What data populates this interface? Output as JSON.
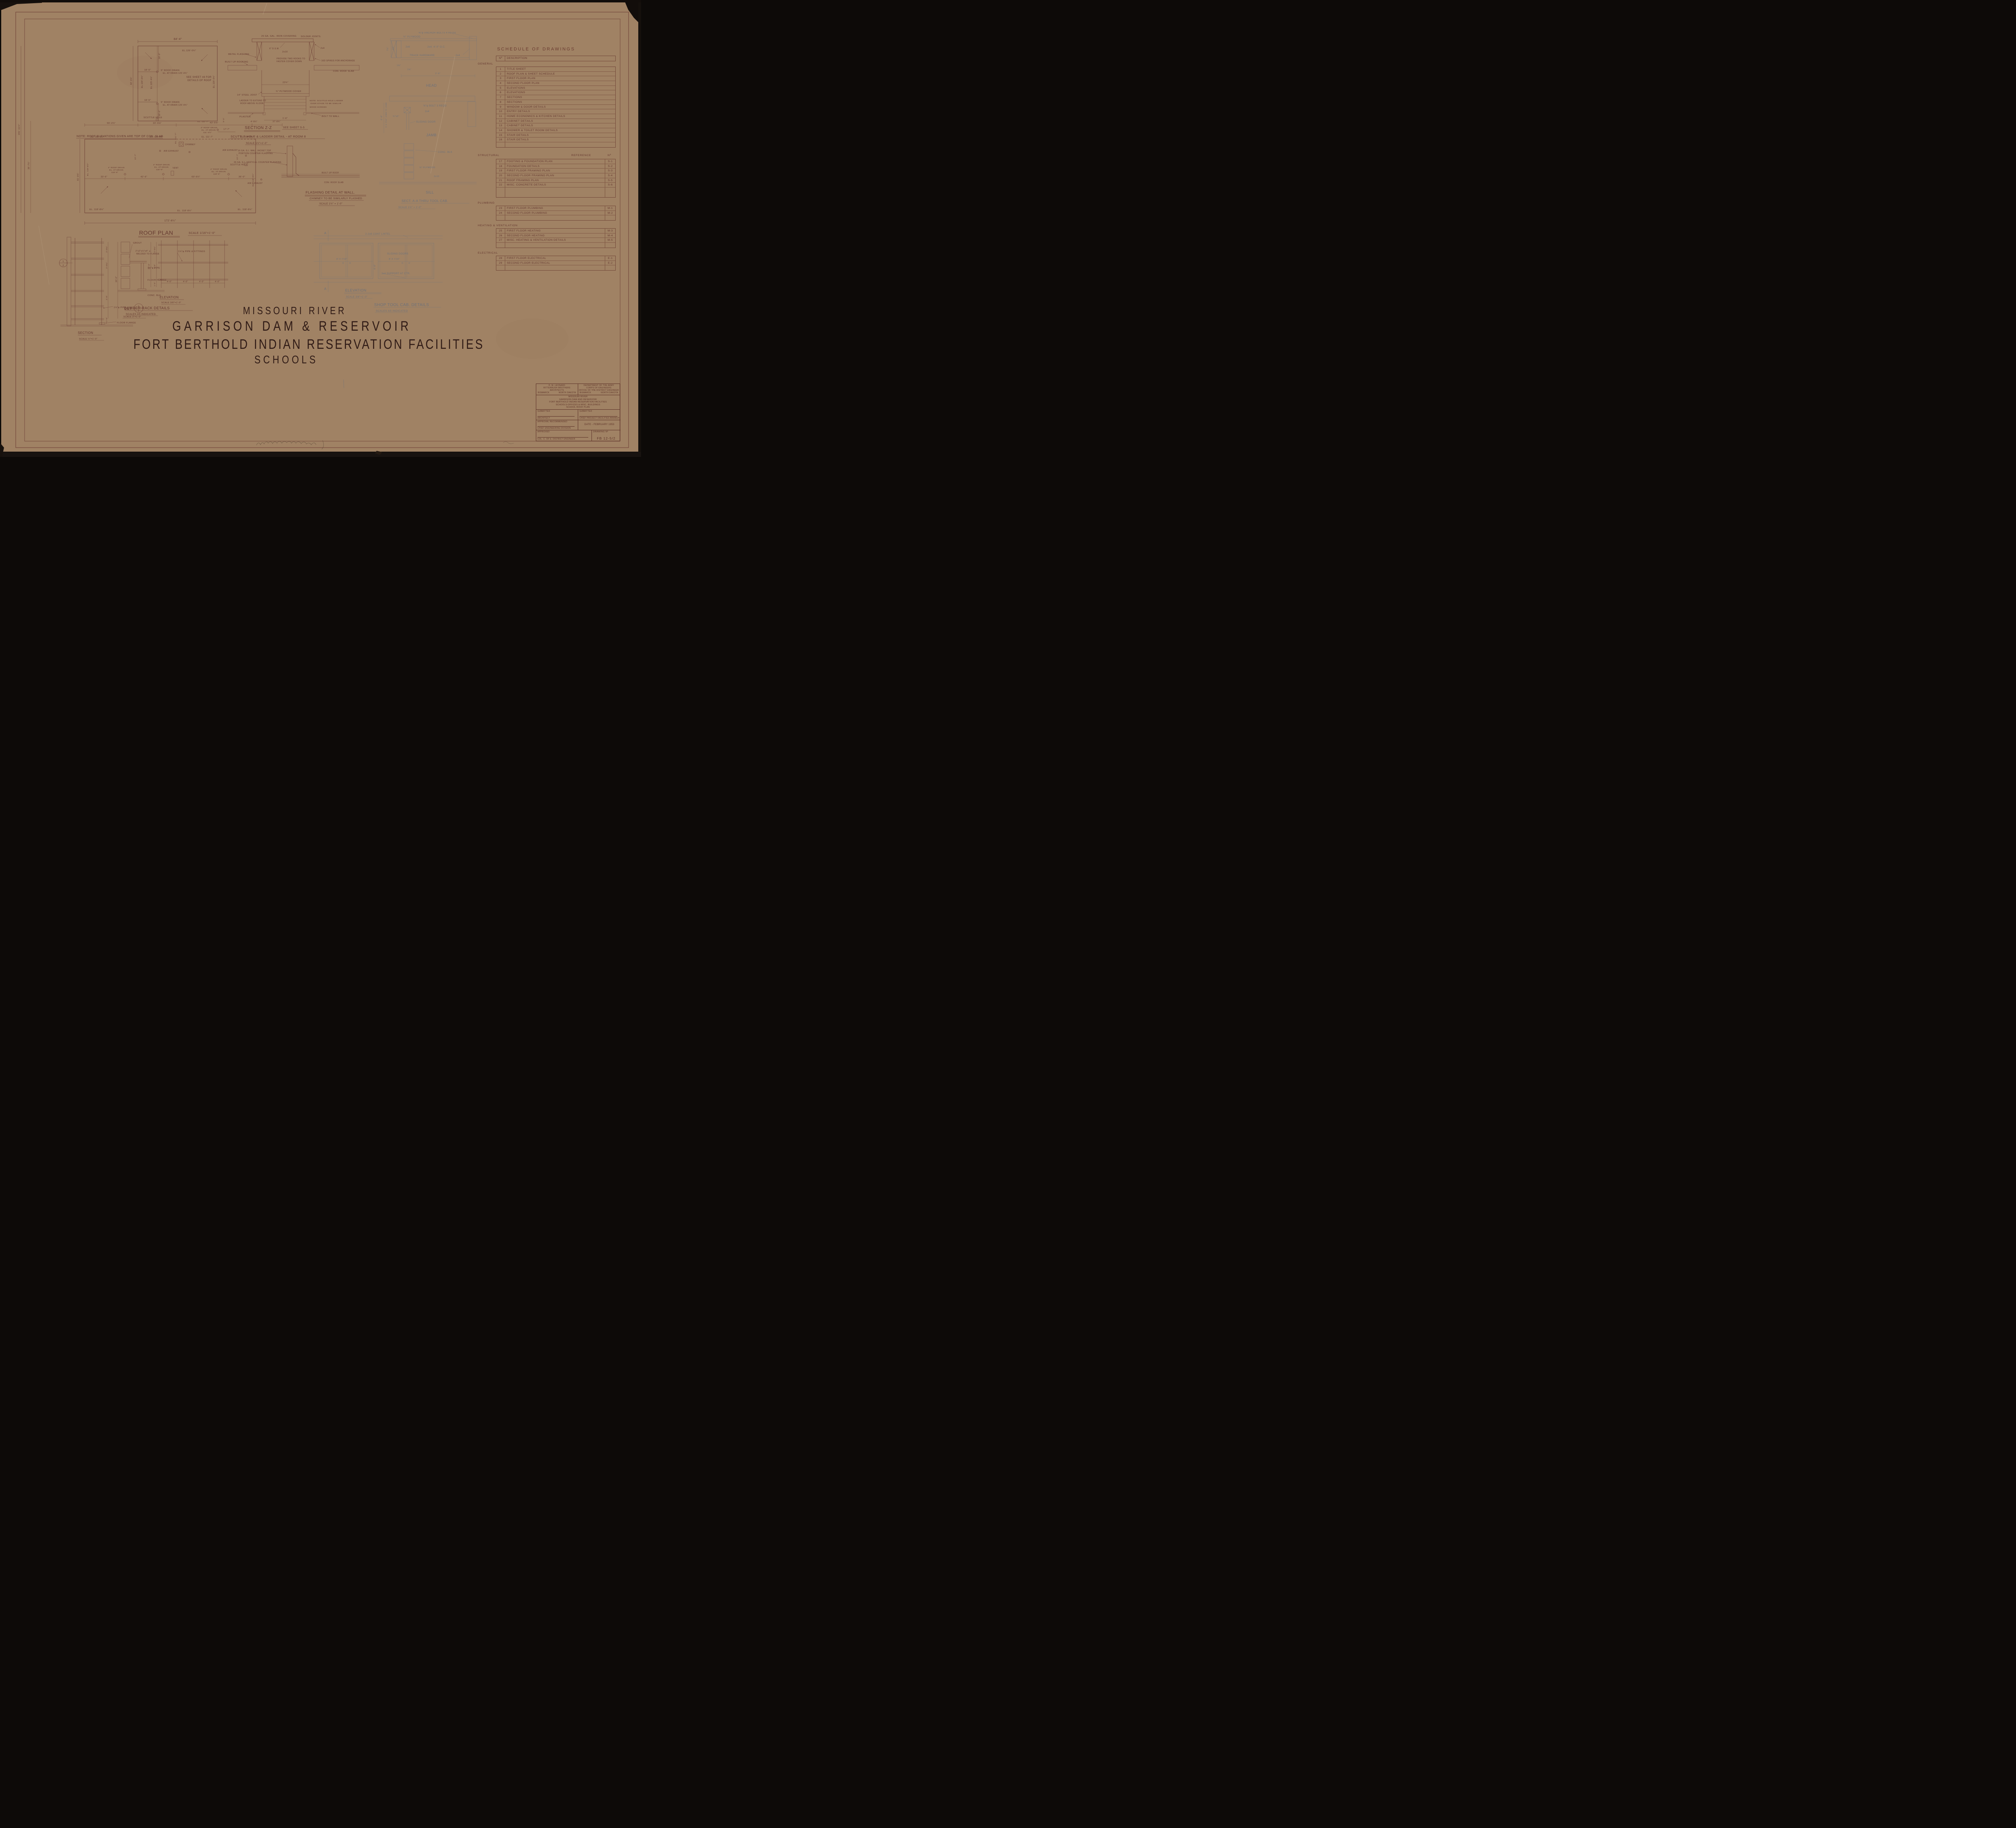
{
  "sheet_title": {
    "l1": "MISSOURI  RIVER",
    "l2": "GARRISON  DAM  &  RESERVOIR",
    "l3": "FORT BERTHOLD  INDIAN  RESERVATION  FACILITIES",
    "l4": "SCHOOLS"
  },
  "schedule": {
    "title": "SCHEDULE  OF  DRAWINGS",
    "col_no": "Nº",
    "col_desc": "DESCRIPTION",
    "ref_label": "REFERENCE",
    "ref_no": "Nº",
    "sections": [
      {
        "name": "GENERAL",
        "rows": [
          {
            "no": "1",
            "desc": "TITLE SHEET",
            "ref": ""
          },
          {
            "no": "2",
            "desc": "ROOF PLAN & SHEET SCHEDULE",
            "ref": ""
          },
          {
            "no": "3",
            "desc": "FIRST FLOOR PLAN",
            "ref": ""
          },
          {
            "no": "4",
            "desc": "SECOND FLOOR PLAN",
            "ref": ""
          },
          {
            "no": "5",
            "desc": "ELEVATIONS",
            "ref": ""
          },
          {
            "no": "6",
            "desc": "ELEVATIONS",
            "ref": ""
          },
          {
            "no": "7",
            "desc": "SECTIONS",
            "ref": ""
          },
          {
            "no": "8",
            "desc": "SECTIONS",
            "ref": ""
          },
          {
            "no": "9",
            "desc": "WINDOW & DOOR DETAILS",
            "ref": ""
          },
          {
            "no": "10",
            "desc": "ENTRY DETAILS",
            "ref": ""
          },
          {
            "no": "11",
            "desc": "HOME ECONOMICS & KITCHEN DETAILS",
            "ref": ""
          },
          {
            "no": "12",
            "desc": "CABINET DETAILS",
            "ref": ""
          },
          {
            "no": "13",
            "desc": "CABINET DETAILS",
            "ref": ""
          },
          {
            "no": "14",
            "desc": "SHOWER & TOILET ROOM DETAILS",
            "ref": ""
          },
          {
            "no": "15",
            "desc": "STAIR DETAILS",
            "ref": ""
          },
          {
            "no": "16",
            "desc": "STAIR DETAILS",
            "ref": ""
          }
        ]
      },
      {
        "name": "STRUCTURAL",
        "rows": [
          {
            "no": "17",
            "desc": "FOOTING & FOUNDATION PLAN",
            "ref": "S-1"
          },
          {
            "no": "18",
            "desc": "FOUNDATION DETAILS",
            "ref": "S-2"
          },
          {
            "no": "19",
            "desc": "FIRST FLOOR FRAMING PLAN",
            "ref": "S-3"
          },
          {
            "no": "20",
            "desc": "SECOND FLOOR FRAMING PLAN",
            "ref": "S-4"
          },
          {
            "no": "21",
            "desc": "ROOF FRAMING PLAN",
            "ref": "S-5"
          },
          {
            "no": "22",
            "desc": "MISC. CONCRETE DETAILS",
            "ref": "S-6"
          }
        ]
      },
      {
        "name": "PLUMBING",
        "rows": [
          {
            "no": "23",
            "desc": "FIRST FLOOR PLUMBING",
            "ref": "M-1"
          },
          {
            "no": "24",
            "desc": "SECOND FLOOR PLUMBING",
            "ref": "M-2"
          }
        ]
      },
      {
        "name": "HEATING & VENTILATION",
        "rows": [
          {
            "no": "25",
            "desc": "FIRST FLOOR HEATING",
            "ref": "M-3"
          },
          {
            "no": "26",
            "desc": "SECOND FLOOR HEATING",
            "ref": "M-4"
          },
          {
            "no": "27",
            "desc": "MISC. HEATING & VENTILATION DETAILS",
            "ref": "M-5"
          }
        ]
      },
      {
        "name": "ELECTRICAL",
        "rows": [
          {
            "no": "28",
            "desc": "FIRST FLOOR ELECTRICAL",
            "ref": "E-1"
          },
          {
            "no": "29",
            "desc": "SECOND FLOOR ELECTRICAL",
            "ref": "E-2"
          }
        ]
      }
    ]
  },
  "titleblock": {
    "firm_l1": "H. M. LEONARD",
    "firm_l2": "RITTERBUSH BROTHERS",
    "firm_l3": "ARCHITECTS",
    "firm_city": "BISMARCK",
    "firm_state": "NORTH DAKOTA",
    "army_l1": "DEPARTMENT OF THE ARMY",
    "army_l2": "CORPS OF ENGINEERS",
    "army_l3": "OFFICE OF THE DISTRICT ENGINEER",
    "army_city": "BISMARCK",
    "army_state": "NORTH DAKOTA",
    "proj_l1": "MISSOURI RIVER",
    "proj_l2": "GARRISON DAM AND RESERVOIR",
    "proj_l3": "FORT BERTHOLD INDIAN RESERVATION FACILITIES",
    "proj_l4": "SCHOOLS-OFFICES & MISC. BUILDINGS",
    "proj_l5": "SCHOOL ROOF PLAN",
    "submitted": "SUBMITTED",
    "architect": "ARCHITECT",
    "approval": "APPROVAL RECOMMENDED",
    "chief_eng": "CHIEF ENGINEERING DIVISION",
    "approved": "APPROVED",
    "district_eng": "COL. C. OF E. DISTRICT ENGINEER",
    "chief_proj": "CHIEF PROJECT FACILITIES BRANCH",
    "date": "DATE - FEBRUARY 1953",
    "drawing_no_label": "DRAWING Nº",
    "drawing_no": "FB 12-5/2"
  },
  "roof": {
    "title": "ROOF PLAN",
    "scale": "SCALE 1/16\"=1'-0\"",
    "note": "NOTE:  ROOF ELEVATIONS GIVEN ARE TOP OF CON. SLAB",
    "dim_top": "84'-4\"",
    "el_126": "EL.126'-0¾\"",
    "el_125": "EL.125'-4¾\"",
    "dim_18_0": "18'-0\"",
    "dim_18_5": "18'-5\"",
    "drain5_l1": "5\" ROOF DRAIN",
    "drain5_l2": "EL. AT DRAIN 125'-4¾\"",
    "see_l1": "SEE SHEET #8 FOR",
    "see_l2": "DETAILS OF ROOF",
    "scuttle": "SCUTTLE HOLE",
    "dim_82": "82'-3¾\"",
    "dim_181": "181'-11¾\"",
    "dim_38": "38'-7¼\"",
    "dim_61": "61'-0¾\"",
    "dim_56": "56'-2¼\"",
    "dim_30": "30'-9⅛\"",
    "dim_43": "43'-0⅞\"",
    "dim_8_3": "8'-3\"",
    "dim_4_9": "4'-9¼\"",
    "dim_37": "37'-8¾\"",
    "dim_17_7": "17'-7\"",
    "drain3_l1": "3\" ROOF DRAIN",
    "drain3_l2": "EL. AT DRAIN",
    "drain3_l3": "111'-4½\"",
    "el_111": "EL. 111'-7\"",
    "el_118": "EL. 118'-8½\"",
    "chimney": "CHIMNEY",
    "air_exhaust": "AIR EXHAUST",
    "vent": "VENT",
    "drain4_l1": "4\" ROOF DRAIN",
    "drain4_l2": "EL. AT DRAIN",
    "drain4_l3": "118'-6\"",
    "dim_33": "33'-6\"",
    "dim_42": "42'-6\"",
    "dim_60": "60'-6¼\"",
    "dim_36": "36'-0\"",
    "dim_22_7": "22'-7\"",
    "dim_172": "172'-6¼\""
  },
  "zz": {
    "title": "SECTION Z-Z",
    "see": "SEE SHEET S-5",
    "sub": "SCUTTLE HOLE & LADDER DETAIL - AT ROOM 8",
    "scale": "SCALE 1½\"=1'-0\"",
    "covering": "26 GA. GAL. IRON COVERING",
    "solder": "SOLDER JOINTS.",
    "dsm": "6\" D.S.M.",
    "l2x4": "2x4",
    "metal_flashing": "METAL FLASHING",
    "built_up": "BUILT UP ROOFING",
    "l2x10": "2x10",
    "hooks_l1": "PROVIDE TWO HOOKS TO",
    "hooks_l2": "FASTEN COVER DOWN",
    "spikes": "16D SPIKES FOR ANCHORAGE",
    "slab": "CON. ROOF SLAB",
    "dim_22": "22¾\"",
    "joist": "14\" STEEL JOIST",
    "plywood": "¾\" PLYWOOD COVER",
    "plaster": "PLASTER",
    "bolt": "BOLT TO WALL",
    "dim_16": "1'-6\"",
    "ladder_l1": "LADDER TO EXTEND TO",
    "ladder_l2": "ROOF ABOVE FLOOR.",
    "note_l1": "NOTE: SCUTTLE HOLE LADDER",
    "note_l2": "OVER STAGE TO BE SIMILAR",
    "wood_screws": "WOOD SCREWS"
  },
  "flash": {
    "title": "FLASHING DETAIL AT WALL.",
    "sub": "CHIMNEY TO BE SIMILARLY FLASHED",
    "scale": "SCALE 1½\" = 1'-0\"",
    "jacket_l1": "16 GA. G.I. WALL JACKET TOP",
    "jacket_l2": "PORTION COUNTER FLASHING",
    "vert": "26 GA. G.I. VERTICAL COUNTER FLASHING",
    "built_up": "BUILT UP ROOF",
    "slab": "CON. ROOF SLAB"
  },
  "cab": {
    "anchor": "⅜\"φ ANCHOR BOLTS 4 REQD",
    "plywood34": "¾\" PLYWOOD",
    "l2x6": "2x6",
    "l2x4oc": "2x4. 4'-0\" O.C.",
    "track": "TRACK HARDWARE",
    "l2x4": "2x4",
    "dim_7_34": "7¾\"",
    "dim_1_38": "1⅜\"",
    "dim_2_6": "2'-6\"",
    "head": "HEAD",
    "bolt3": "⅜\"φ BOLT 3 REQD",
    "dim_34x5": "¾\"x5\"",
    "sliding_door": "SLIDING DOOR",
    "jamb": "JAMB",
    "dim_6_8": "6'-8\"",
    "jamb_to_jamb": "5'-4 7/16\" JAMB TO JAMB",
    "conc_blk": "CONC. BLK",
    "plywood58": "⅝\" PLYWOOD",
    "l2x10": "2x10",
    "sill": "SILL",
    "sect": "SECT. A-A THRU TOOL CAB.",
    "sect_scale": "SCALE 1½\" = 1'-0\"",
    "lintel": "2-2x6 CONT LINTEL",
    "sliding_doors": "SLIDING DOORS",
    "dim_8_4": "8'-4 7/16\"",
    "support": "2x4 SUPPORT AT CTR.",
    "marker_a": "A",
    "elev_title": "ELEVATION",
    "elev_scale": "SCALE 3/8\"=1'-0\"",
    "group_title": "SHOP TOOL CAB. DETAILS",
    "group_scale": "SCALES AS INDICATED"
  },
  "rack": {
    "grout": "GROUT",
    "angle_l1": "2\"x2\"x¼\"x4\" ∠",
    "angle_l2": "WELDED TO FLANGE",
    "pipe": "1½\"φ PIPE",
    "floor_flange": "FLOOR FLANGE",
    "conc_blk": "CONC. BLK",
    "det": "DET",
    "det_no": "1",
    "det_den": "2",
    "det_scale": "SCALE 3\"=1'-0\"",
    "pipe_fittings": "1½\"φ PIPE & FITTINGS",
    "dim_4_0": "4'-0\"",
    "dim_10_0": "10'-0\"",
    "dim_2_0": "2'-0¾\"",
    "dim_2_9": "2'-9\"",
    "dim_1_5": "1'-5\"",
    "elev_title": "ELEVATION",
    "elev_scale": "SCALE 3/8\"=1'-0\"",
    "section_title": "SECTION",
    "section_scale": "SCALE ½\"=1'-0\"",
    "group_title": "LUMBER RACK DETAILS",
    "group_scale": "SCALES AS INDICATED."
  }
}
